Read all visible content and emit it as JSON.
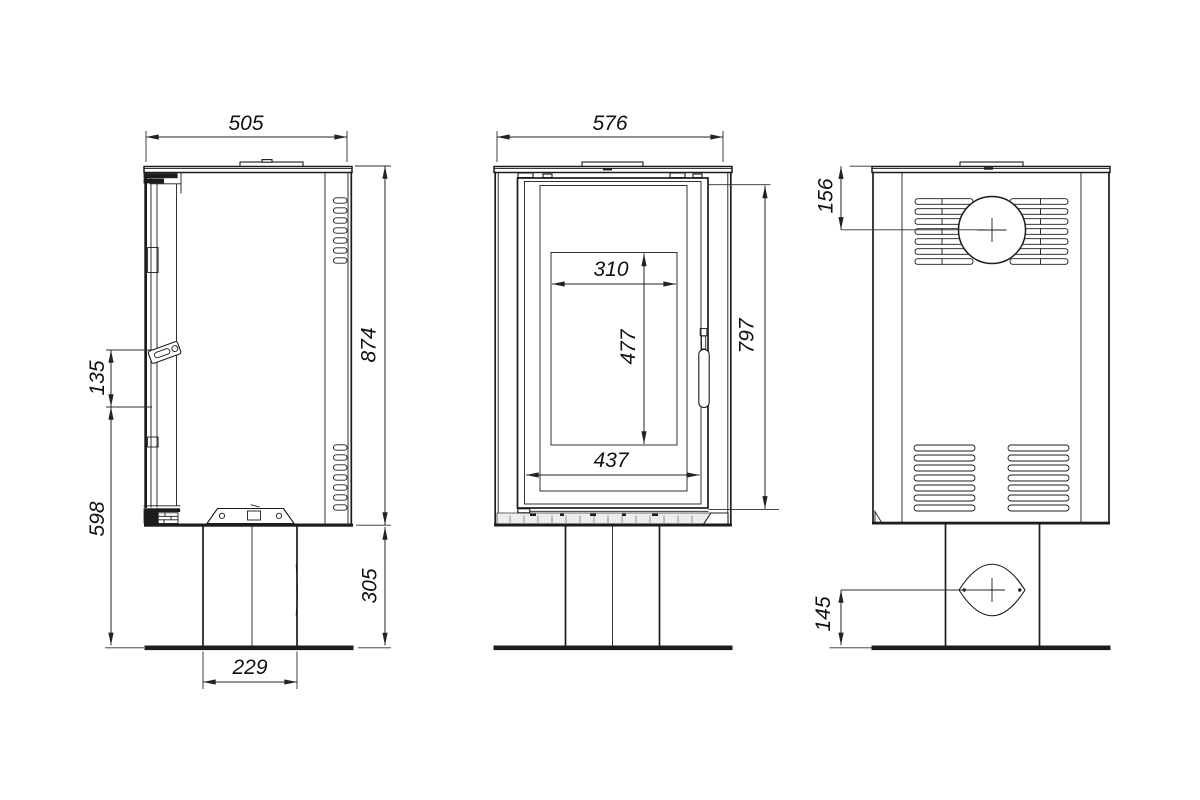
{
  "drawing": {
    "type": "technical-orthographic-drawing",
    "subject": "freestanding stove on pedestal, three views (side, front, back)",
    "background": "#ffffff",
    "line_color": "#1c1c1c",
    "dimension_color": "#232323",
    "dimensions": {
      "side_depth": "505",
      "body_height": "874",
      "handle_offset": "135",
      "door_base_height": "598",
      "pedestal_height": "305",
      "pedestal_depth": "229",
      "front_width": "576",
      "glass_width": "310",
      "glass_height": "477",
      "door_width": "437",
      "door_height": "797",
      "flue_center_from_top": "156",
      "air_inlet_center_from_base": "145"
    }
  }
}
